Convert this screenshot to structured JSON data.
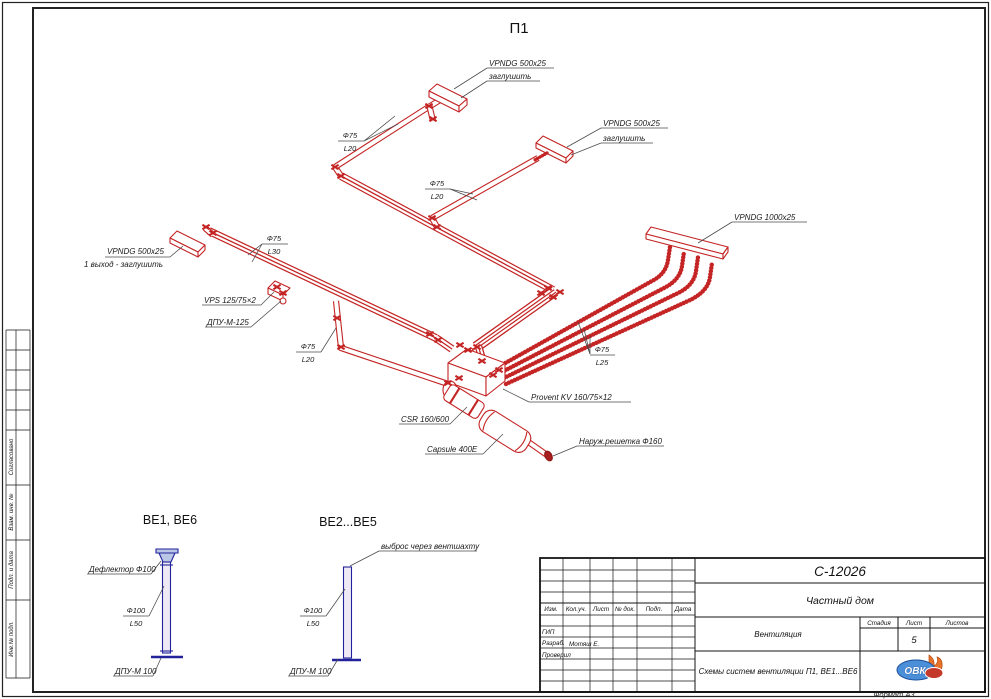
{
  "frame": {
    "format_note": "Формат А3",
    "stamp": {
      "approved": "Согласовано",
      "vzam": "Взам. инв. №",
      "podp": "Подп. и дата",
      "inv": "Инв.№ подл."
    }
  },
  "diagram": {
    "title": "П1",
    "labels": {
      "g_top1": "VPNDG 500x25",
      "g_top1_note": "заглушить",
      "g_top2": "VPNDG 500x25",
      "g_top2_note": "заглушить",
      "g_right": "VPNDG 1000x25",
      "g_left": "VPNDG 500x25",
      "g_left_note": "1 выход - заглушить",
      "vps": "VPS 125/75×2",
      "dpu125": "ДПУ-М-125",
      "provent": "Provent KV 160/75×12",
      "csr": "CSR 160/600",
      "capsule": "Capsule 400E",
      "grate": "Наруж.решетка Ф160"
    },
    "dims": [
      {
        "d": "Ф75",
        "l": "L20"
      },
      {
        "d": "Ф75",
        "l": "L20"
      },
      {
        "d": "Ф75",
        "l": "L30"
      },
      {
        "d": "Ф75",
        "l": "L20"
      },
      {
        "d": "Ф75",
        "l": "L25"
      }
    ]
  },
  "be": {
    "be1": {
      "title": "ВЕ1, ВЕ6",
      "deflector": "Дефлектор Ф100",
      "dim_d": "Ф100",
      "dim_l": "L50",
      "dpu": "ДПУ-М 100"
    },
    "be2": {
      "title": "ВЕ2...ВЕ5",
      "note": "выброс через вентшахту",
      "dim_d": "Ф100",
      "dim_l": "L50",
      "dpu": "ДПУ-М 100"
    }
  },
  "titleblock": {
    "doc_number": "С-12026",
    "object_name": "Частный дом",
    "section": "Вентиляция",
    "sheet_title": "Схемы систем вентиляции П1, ВЕ1...ВЕ6",
    "stage_label": "Стадия",
    "sheet_label": "Лист",
    "sheets_label": "Листов",
    "sheet_number": "5",
    "columns": [
      "Изм.",
      "Кол.уч.",
      "Лист",
      "№ док.",
      "Подп.",
      "Дата"
    ],
    "roles": [
      {
        "label": "ГИП",
        "name": ""
      },
      {
        "label": "Разраб.",
        "name": "Мотяш Е."
      },
      {
        "label": "Проверил",
        "name": ""
      }
    ],
    "logo_text": "ОВК"
  }
}
